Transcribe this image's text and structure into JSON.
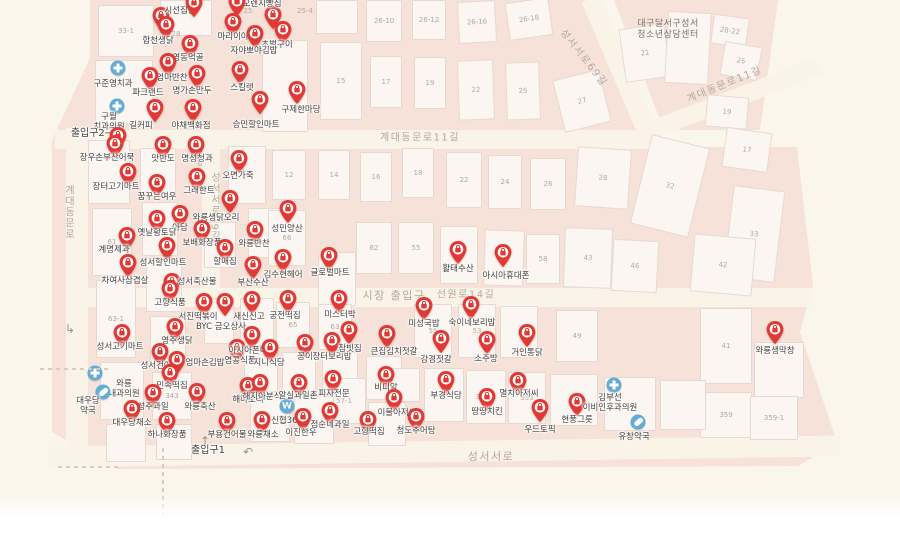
{
  "map_type": "korean-market-map",
  "palette": {
    "block_pink": "#f6e2d8",
    "road_cream": "#faf3e8",
    "base_cream": "#fbf6ec",
    "building_fill": "#fbf6f1",
    "building_border": "#e8d9d0",
    "pin_red": "#e03a36",
    "medical_blue": "#64abd6",
    "poi_text": "#46403c",
    "street_text": "#b5a89d",
    "number_text": "#b3a9a1"
  },
  "streets": [
    {
      "t": "계대동문로11길",
      "x": 420,
      "y": 136,
      "rot": 0,
      "fs": 10
    },
    {
      "t": "계대동문로11길",
      "x": 724,
      "y": 83,
      "rot": -22,
      "fs": 10
    },
    {
      "t": "성서서로69길",
      "x": 585,
      "y": 57,
      "rot": 52,
      "fs": 10
    },
    {
      "t": "성서서로69길",
      "x": 214,
      "y": 207,
      "rot": 0,
      "vert": true,
      "fs": 10
    },
    {
      "t": "계대동문로",
      "x": 68,
      "y": 212,
      "rot": 0,
      "vert": true,
      "fs": 10
    },
    {
      "t": "선원로14길",
      "x": 466,
      "y": 293,
      "rot": 0,
      "fs": 10
    },
    {
      "t": "시장 출입구",
      "x": 394,
      "y": 295,
      "rot": 0,
      "fs": 11
    },
    {
      "t": "성서서로",
      "x": 491,
      "y": 456,
      "rot": 0,
      "fs": 11
    }
  ],
  "facility": {
    "t": "대구달서구성서\n청소년상담센터",
    "x": 668,
    "y": 30
  },
  "pois": [
    {
      "t": "시선집중",
      "p": [
        161,
        16
      ],
      "l": [
        180,
        11
      ]
    },
    {
      "t": "오렌지빵집",
      "p": [
        273,
        15
      ],
      "l": [
        262,
        4
      ]
    },
    {
      "t": "마리이야기",
      "p": [
        233,
        22
      ],
      "l": [
        237,
        37
      ]
    },
    {
      "t": "합천생닭",
      "p": [
        166,
        25
      ],
      "l": [
        158,
        41
      ]
    },
    {
      "t": "초벌구이",
      "p": [
        283,
        30
      ],
      "l": [
        277,
        45
      ]
    },
    {
      "t": "자야뽀야김밥",
      "p": [
        255,
        34
      ],
      "l": [
        254,
        51
      ]
    },
    {
      "t": "영동먹골",
      "p": [
        190,
        44
      ],
      "l": [
        188,
        58
      ]
    },
    {
      "t": "율엄마반찬",
      "p": [
        168,
        62
      ],
      "l": [
        168,
        78
      ]
    },
    {
      "t": "명가손만두",
      "p": [
        197,
        74
      ],
      "l": [
        192,
        91
      ]
    },
    {
      "t": "스킬렛",
      "p": [
        240,
        70
      ],
      "l": [
        242,
        88
      ]
    },
    {
      "t": "구준영치과",
      "p": [
        118,
        68
      ],
      "l": [
        113,
        84
      ],
      "ic": "cross"
    },
    {
      "t": "파크랜드",
      "p": [
        150,
        76
      ],
      "l": [
        148,
        93
      ]
    },
    {
      "t": "구월\n치과의원",
      "p": [
        117,
        106
      ],
      "l": [
        109,
        122
      ],
      "ic": "cross"
    },
    {
      "t": "길커피",
      "p": [
        155,
        108
      ],
      "l": [
        141,
        126
      ]
    },
    {
      "t": "야채백화점",
      "p": [
        193,
        108
      ],
      "l": [
        191,
        126
      ]
    },
    {
      "t": "승민할인마트",
      "p": [
        260,
        100
      ],
      "l": [
        256,
        125
      ]
    },
    {
      "t": "구제한마당",
      "p": [
        297,
        90
      ],
      "l": [
        301,
        110
      ]
    },
    {
      "t": "출입구2→",
      "l": [
        92,
        134
      ],
      "ic": "text"
    },
    {
      "t": "",
      "p": [
        118,
        136
      ]
    },
    {
      "t": "",
      "p": [
        194,
        3
      ]
    },
    {
      "t": "",
      "p": [
        237,
        2
      ]
    },
    {
      "t": "장우손부산어묵",
      "p": [
        115,
        144
      ],
      "l": [
        107,
        158
      ]
    },
    {
      "t": "맛반도",
      "p": [
        163,
        145
      ],
      "l": [
        163,
        159
      ]
    },
    {
      "t": "명성청과",
      "p": [
        196,
        145
      ],
      "l": [
        197,
        159
      ]
    },
    {
      "t": "장터고기마트",
      "p": [
        128,
        172
      ],
      "l": [
        116,
        187
      ]
    },
    {
      "t": "그래한트",
      "p": [
        197,
        177
      ],
      "l": [
        199,
        191
      ]
    },
    {
      "t": "꿈꾸는여우",
      "p": [
        157,
        183
      ],
      "l": [
        157,
        197
      ]
    },
    {
      "t": "오면가죽",
      "p": [
        239,
        159
      ],
      "l": [
        238,
        176
      ]
    },
    {
      "t": "와룡생닭오리",
      "p": [
        230,
        199
      ],
      "l": [
        216,
        218
      ]
    },
    {
      "t": "아담",
      "p": [
        180,
        214
      ],
      "l": [
        180,
        228
      ]
    },
    {
      "t": "옛날황토닭",
      "p": [
        157,
        219
      ],
      "l": [
        157,
        233
      ]
    },
    {
      "t": "보배화장품",
      "p": [
        202,
        229
      ],
      "l": [
        202,
        243
      ]
    },
    {
      "t": "계명제과",
      "p": [
        127,
        236
      ],
      "l": [
        114,
        250
      ]
    },
    {
      "t": "차여사삼겹살",
      "p": [
        128,
        263
      ],
      "l": [
        125,
        281
      ]
    },
    {
      "t": "성서할인마트",
      "p": [
        167,
        246
      ],
      "l": [
        163,
        263
      ]
    },
    {
      "t": "할매집",
      "p": [
        225,
        248
      ],
      "l": [
        225,
        262
      ]
    },
    {
      "t": "성서축산물",
      "p": [
        172,
        282
      ],
      "l": [
        197,
        282
      ]
    },
    {
      "t": "고향식품",
      "p": [
        170,
        289
      ],
      "l": [
        170,
        303
      ]
    },
    {
      "t": "서진떡볶이",
      "p": [
        204,
        302
      ],
      "l": [
        198,
        317
      ]
    },
    {
      "t": "BYC 금오상사",
      "p": [
        225,
        302
      ],
      "l": [
        221,
        327
      ]
    },
    {
      "t": "성서고기마트",
      "p": [
        122,
        333
      ],
      "l": [
        120,
        347
      ]
    },
    {
      "t": "영주생닭",
      "p": [
        175,
        327
      ],
      "l": [
        177,
        341
      ]
    },
    {
      "t": "성서건어물",
      "p": [
        160,
        352
      ],
      "l": [
        160,
        366
      ]
    },
    {
      "t": "엄마손김밥",
      "p": [
        177,
        360
      ],
      "l": [
        205,
        363
      ]
    },
    {
      "t": "염콩식품",
      "p": [
        237,
        348
      ],
      "l": [
        240,
        361
      ]
    },
    {
      "t": "민속떡집",
      "p": [
        170,
        373
      ],
      "l": [
        172,
        386
      ]
    },
    {
      "t": "성주과일",
      "p": [
        153,
        393
      ],
      "l": [
        153,
        407
      ]
    },
    {
      "t": "와룡축산",
      "p": [
        197,
        392
      ],
      "l": [
        200,
        407
      ]
    },
    {
      "t": "와룡\n내과의원",
      "p": [
        95,
        373
      ],
      "l": [
        124,
        389
      ],
      "ic": "cross"
    },
    {
      "t": "대우당\n약국",
      "p": [
        103,
        392
      ],
      "l": [
        88,
        406
      ],
      "ic": "pill"
    },
    {
      "t": "대우당채소",
      "p": [
        132,
        409
      ],
      "l": [
        132,
        423
      ]
    },
    {
      "t": "하나화장품",
      "p": [
        167,
        421
      ],
      "l": [
        167,
        435
      ]
    },
    {
      "t": "부용건어물",
      "p": [
        227,
        421
      ],
      "l": [
        227,
        435
      ]
    },
    {
      "t": "출입구1",
      "l": [
        208,
        451
      ],
      "ic": "text"
    },
    {
      "t": "해마오리",
      "p": [
        248,
        386
      ],
      "l": [
        248,
        400
      ]
    },
    {
      "t": "해지아분식",
      "p": [
        260,
        383
      ],
      "l": [
        262,
        397
      ]
    },
    {
      "t": "와룡채소",
      "p": [
        262,
        420
      ],
      "l": [
        263,
        435
      ]
    },
    {
      "t": "신협365",
      "p": [
        287,
        406
      ],
      "l": [
        287,
        421
      ],
      "ic": "won"
    },
    {
      "t": "알실과일촌",
      "p": [
        299,
        383
      ],
      "l": [
        298,
        396
      ]
    },
    {
      "t": "이진한우",
      "p": [
        303,
        417
      ],
      "l": [
        301,
        433
      ]
    },
    {
      "t": "점순네과일",
      "p": [
        330,
        411
      ],
      "l": [
        330,
        425
      ]
    },
    {
      "t": "피자전문",
      "p": [
        333,
        379
      ],
      "l": [
        334,
        394
      ]
    },
    {
      "t": "비디알",
      "p": [
        386,
        375
      ],
      "l": [
        386,
        388
      ]
    },
    {
      "t": "고향떡집",
      "p": [
        368,
        420
      ],
      "l": [
        369,
        432
      ]
    },
    {
      "t": "이불아저씨",
      "p": [
        394,
        398
      ],
      "l": [
        397,
        413
      ]
    },
    {
      "t": "청도추어탕",
      "p": [
        416,
        417
      ],
      "l": [
        416,
        431
      ]
    },
    {
      "t": "부경식당",
      "p": [
        446,
        380
      ],
      "l": [
        446,
        396
      ]
    },
    {
      "t": "땅땅치킨",
      "p": [
        487,
        397
      ],
      "l": [
        487,
        412
      ]
    },
    {
      "t": "멸치아저씨",
      "p": [
        518,
        381
      ],
      "l": [
        519,
        394
      ]
    },
    {
      "t": "우드토픽",
      "p": [
        540,
        408
      ],
      "l": [
        540,
        430
      ]
    },
    {
      "t": "현풍그릇",
      "p": [
        577,
        402
      ],
      "l": [
        577,
        420
      ]
    },
    {
      "t": "김부선\n이비인후과의원",
      "p": [
        614,
        385
      ],
      "l": [
        610,
        403
      ],
      "ic": "cross"
    },
    {
      "t": "유창약국",
      "p": [
        638,
        422
      ],
      "l": [
        634,
        437
      ],
      "ic": "pill"
    },
    {
      "t": "미성국밥",
      "p": [
        424,
        306
      ],
      "l": [
        424,
        324
      ]
    },
    {
      "t": "숙이네보리밥",
      "p": [
        471,
        305
      ],
      "l": [
        472,
        323
      ]
    },
    {
      "t": "강경젓갈",
      "p": [
        441,
        339
      ],
      "l": [
        436,
        360
      ]
    },
    {
      "t": "소주방",
      "p": [
        487,
        340
      ],
      "l": [
        486,
        359
      ]
    },
    {
      "t": "거인통닭",
      "p": [
        527,
        333
      ],
      "l": [
        527,
        353
      ]
    },
    {
      "t": "큰집김치젓갈",
      "p": [
        387,
        334
      ],
      "l": [
        394,
        352
      ]
    },
    {
      "t": "미스터박",
      "p": [
        339,
        299
      ],
      "l": [
        340,
        315
      ]
    },
    {
      "t": "궁전떡집",
      "p": [
        288,
        299
      ],
      "l": [
        285,
        316
      ]
    },
    {
      "t": "새신신고",
      "p": [
        252,
        300
      ],
      "l": [
        249,
        317
      ]
    },
    {
      "t": "아시아폰마트",
      "p": [
        252,
        335
      ],
      "l": [
        252,
        351
      ]
    },
    {
      "t": "지니식당",
      "p": [
        270,
        348
      ],
      "l": [
        269,
        363
      ]
    },
    {
      "t": "꽁이",
      "p": [
        305,
        343
      ],
      "l": [
        305,
        357
      ]
    },
    {
      "t": "장터보리밥",
      "p": [
        332,
        341
      ],
      "l": [
        332,
        357
      ]
    },
    {
      "t": "참빗집",
      "p": [
        349,
        330
      ],
      "l": [
        350,
        349
      ]
    },
    {
      "t": "성민양산",
      "p": [
        288,
        209
      ],
      "l": [
        287,
        229
      ]
    },
    {
      "t": "와룡반찬",
      "p": [
        255,
        230
      ],
      "l": [
        254,
        244
      ]
    },
    {
      "t": "김수현헤어",
      "p": [
        283,
        258
      ],
      "l": [
        283,
        275
      ]
    },
    {
      "t": "글로벌마트",
      "p": [
        329,
        256
      ],
      "l": [
        330,
        273
      ]
    },
    {
      "t": "부산수산",
      "p": [
        253,
        265
      ],
      "l": [
        253,
        283
      ]
    },
    {
      "t": "활태수산",
      "p": [
        458,
        250
      ],
      "l": [
        458,
        269
      ]
    },
    {
      "t": "아시아휴대폰",
      "p": [
        503,
        253
      ],
      "l": [
        506,
        276
      ]
    },
    {
      "t": "와룡생막창",
      "p": [
        775,
        330
      ],
      "l": [
        775,
        351
      ]
    }
  ],
  "buildings": [
    [
      98,
      5,
      56,
      52,
      0,
      "33-1"
    ],
    [
      160,
      0,
      52,
      36,
      0,
      ""
    ],
    [
      95,
      60,
      58,
      64,
      0,
      ""
    ],
    [
      262,
      40,
      46,
      92,
      0,
      ""
    ],
    [
      320,
      42,
      42,
      78,
      0,
      "15"
    ],
    [
      370,
      56,
      32,
      52,
      0,
      "17"
    ],
    [
      414,
      57,
      32,
      52,
      0,
      "19"
    ],
    [
      458,
      60,
      36,
      60,
      -2,
      "22"
    ],
    [
      506,
      62,
      34,
      58,
      -2,
      "25"
    ],
    [
      558,
      74,
      48,
      54,
      -14,
      "27"
    ],
    [
      316,
      0,
      42,
      34,
      0,
      ""
    ],
    [
      366,
      0,
      36,
      42,
      0,
      "26-10"
    ],
    [
      412,
      0,
      34,
      40,
      0,
      "26-12"
    ],
    [
      458,
      1,
      38,
      42,
      -3,
      "26-16"
    ],
    [
      507,
      0,
      44,
      38,
      -8,
      "26-18"
    ],
    [
      622,
      26,
      46,
      54,
      -8,
      "21"
    ],
    [
      666,
      12,
      44,
      72,
      3,
      ""
    ],
    [
      712,
      16,
      36,
      30,
      8,
      "28-22"
    ],
    [
      722,
      44,
      38,
      34,
      10,
      "25"
    ],
    [
      706,
      96,
      42,
      32,
      5,
      "19"
    ],
    [
      576,
      148,
      54,
      60,
      4,
      "28"
    ],
    [
      640,
      140,
      60,
      92,
      14,
      "32"
    ],
    [
      724,
      130,
      46,
      40,
      8,
      "17"
    ],
    [
      728,
      188,
      52,
      92,
      7,
      "33"
    ],
    [
      564,
      228,
      48,
      60,
      2,
      "43"
    ],
    [
      612,
      240,
      46,
      52,
      3,
      "46"
    ],
    [
      692,
      236,
      62,
      58,
      5,
      "42"
    ],
    [
      318,
      150,
      32,
      50,
      0,
      "14"
    ],
    [
      360,
      152,
      32,
      50,
      0,
      "16"
    ],
    [
      402,
      148,
      32,
      50,
      0,
      "18"
    ],
    [
      446,
      152,
      36,
      56,
      0,
      "22"
    ],
    [
      488,
      155,
      34,
      54,
      0,
      "24"
    ],
    [
      530,
      158,
      36,
      52,
      0,
      "26"
    ],
    [
      356,
      222,
      36,
      52,
      0,
      "62"
    ],
    [
      398,
      222,
      36,
      52,
      0,
      "55"
    ],
    [
      440,
      226,
      38,
      58,
      0,
      ""
    ],
    [
      484,
      230,
      40,
      56,
      2,
      ""
    ],
    [
      526,
      234,
      34,
      50,
      0,
      "58"
    ],
    [
      700,
      308,
      52,
      76,
      0,
      "41"
    ],
    [
      700,
      392,
      52,
      46,
      0,
      "359"
    ],
    [
      754,
      342,
      50,
      56,
      0,
      ""
    ],
    [
      750,
      396,
      48,
      44,
      0,
      "359-1"
    ],
    [
      424,
      368,
      40,
      54,
      0,
      "355"
    ],
    [
      466,
      370,
      40,
      54,
      0,
      "357-1"
    ],
    [
      508,
      372,
      38,
      52,
      0,
      "353"
    ],
    [
      550,
      374,
      48,
      52,
      0,
      ""
    ],
    [
      604,
      377,
      52,
      54,
      0,
      ""
    ],
    [
      660,
      380,
      46,
      50,
      0,
      ""
    ],
    [
      414,
      304,
      38,
      54,
      0,
      "55"
    ],
    [
      458,
      304,
      38,
      54,
      0,
      "53"
    ],
    [
      500,
      306,
      38,
      52,
      0,
      ""
    ],
    [
      556,
      310,
      42,
      52,
      0,
      "49"
    ],
    [
      228,
      146,
      38,
      58,
      0,
      ""
    ],
    [
      272,
      150,
      34,
      50,
      0,
      "12"
    ],
    [
      248,
      208,
      34,
      50,
      0,
      ""
    ],
    [
      268,
      210,
      38,
      56,
      0,
      "66"
    ],
    [
      318,
      252,
      38,
      54,
      0,
      ""
    ],
    [
      88,
      140,
      42,
      64,
      0,
      ""
    ],
    [
      92,
      208,
      40,
      68,
      0,
      "61"
    ],
    [
      96,
      280,
      40,
      78,
      0,
      "63-1"
    ],
    [
      100,
      362,
      44,
      58,
      0,
      ""
    ],
    [
      106,
      424,
      40,
      38,
      0,
      ""
    ],
    [
      140,
      148,
      36,
      50,
      0,
      ""
    ],
    [
      142,
      202,
      36,
      54,
      0,
      ""
    ],
    [
      146,
      258,
      36,
      54,
      0,
      ""
    ],
    [
      150,
      316,
      36,
      50,
      0,
      ""
    ],
    [
      152,
      372,
      40,
      48,
      0,
      "343"
    ],
    [
      156,
      424,
      36,
      36,
      0,
      ""
    ],
    [
      204,
      222,
      32,
      46,
      0,
      ""
    ],
    [
      240,
      298,
      34,
      48,
      0,
      ""
    ],
    [
      276,
      302,
      34,
      46,
      0,
      "65"
    ],
    [
      318,
      304,
      34,
      46,
      0,
      "63"
    ],
    [
      204,
      298,
      30,
      46,
      0,
      ""
    ],
    [
      244,
      350,
      34,
      42,
      0,
      ""
    ],
    [
      282,
      352,
      34,
      42,
      0,
      ""
    ],
    [
      322,
      352,
      36,
      44,
      0,
      ""
    ],
    [
      322,
      378,
      44,
      46,
      0,
      "57-1"
    ],
    [
      366,
      356,
      36,
      44,
      0,
      ""
    ],
    [
      250,
      394,
      40,
      48,
      0,
      ""
    ],
    [
      294,
      396,
      40,
      48,
      0,
      ""
    ],
    [
      368,
      402,
      38,
      44,
      0,
      ""
    ],
    [
      390,
      368,
      30,
      34,
      0,
      ""
    ]
  ],
  "numbers": [
    [
      "25",
      248,
      11
    ],
    [
      "25-4",
      305,
      11
    ],
    [
      "28",
      176,
      34
    ],
    [
      "1",
      177,
      91
    ],
    [
      "6",
      200,
      164
    ],
    [
      "10",
      243,
      242
    ]
  ],
  "glyphs": [
    {
      "g": "↑",
      "x": 205,
      "y": 441
    },
    {
      "g": "↶",
      "x": 248,
      "y": 452
    },
    {
      "g": "↳",
      "x": 70,
      "y": 329
    }
  ]
}
